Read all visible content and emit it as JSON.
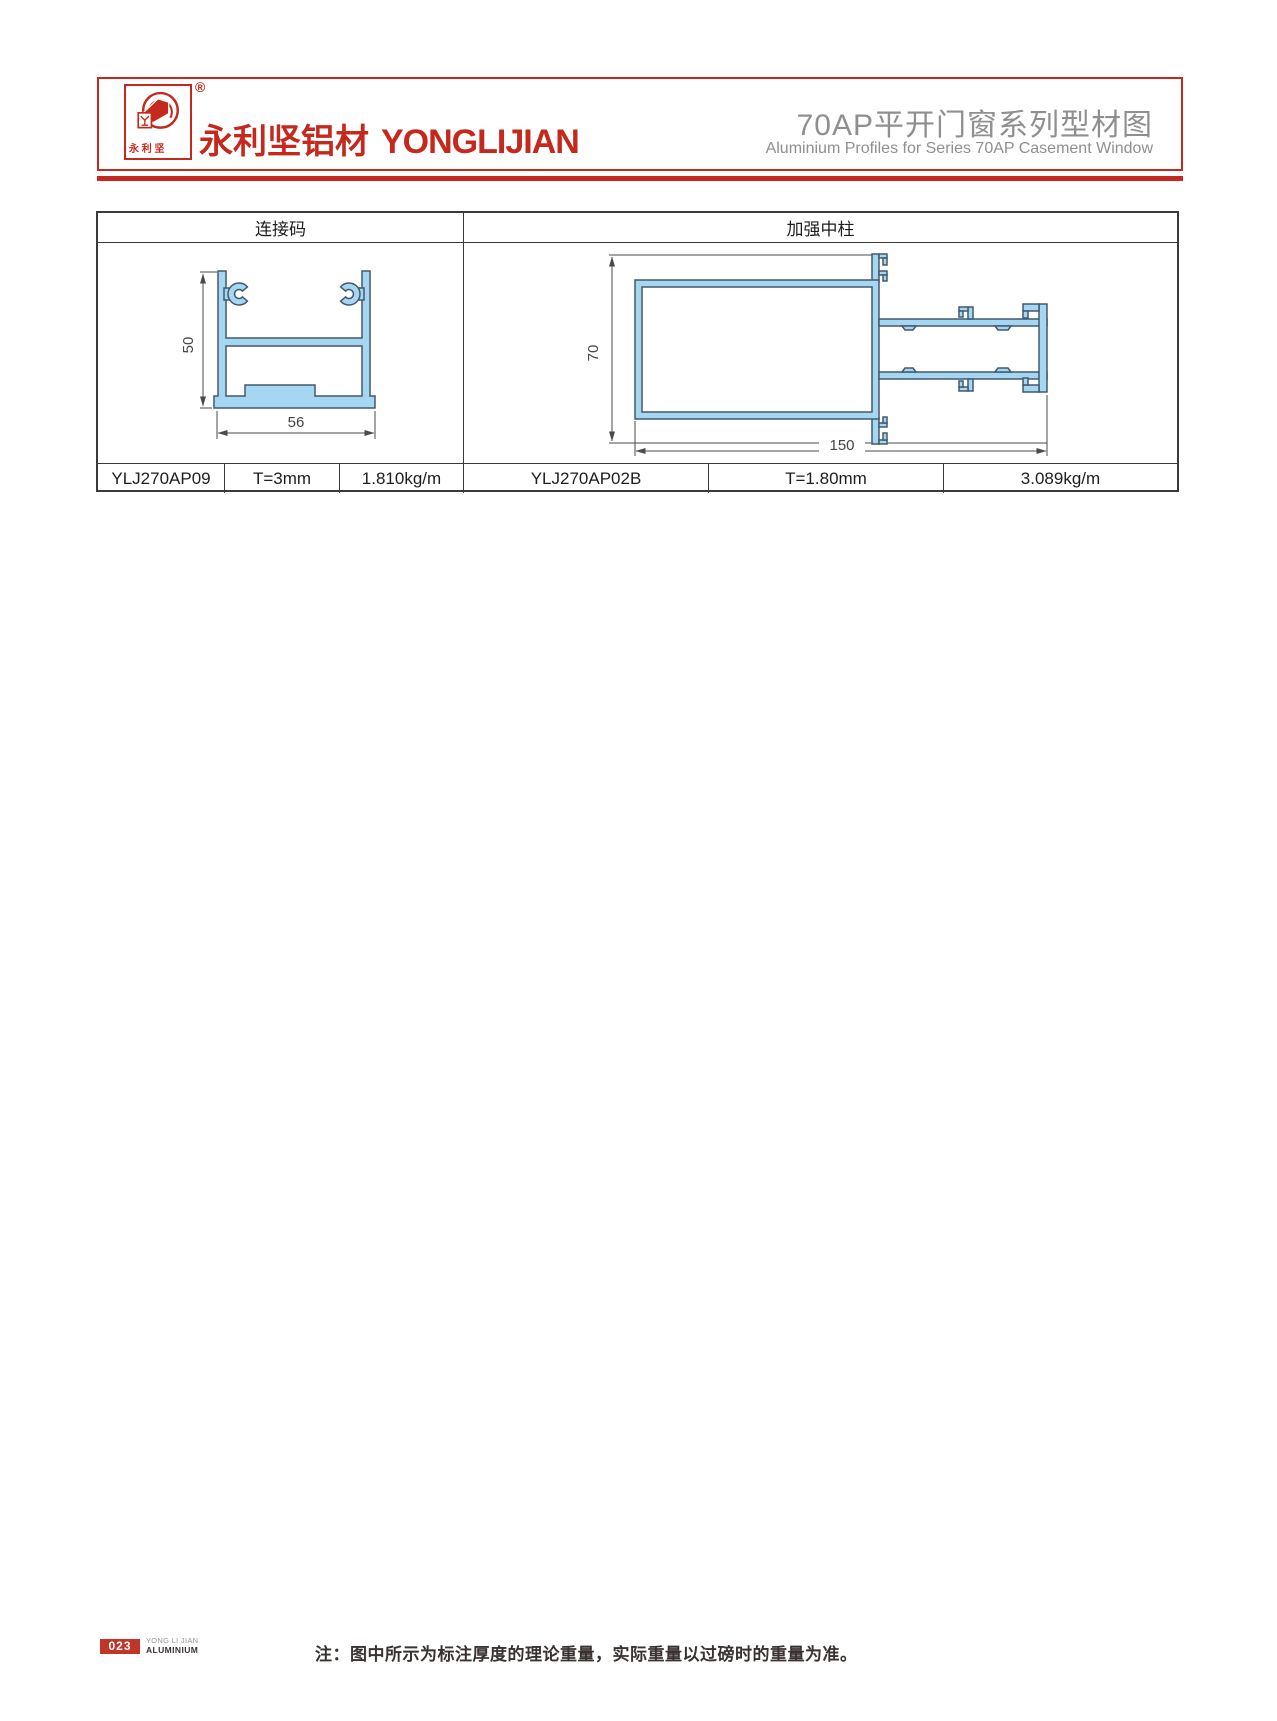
{
  "header": {
    "logo_chars": "永 利 坚",
    "registered_mark": "®",
    "brand_cn": "永利坚铝材",
    "brand_en": "YONGLIJIAN",
    "title_cn": "70AP平开门窗系列型材图",
    "title_en": "Aluminium Profiles for Series 70AP Casement Window"
  },
  "table": {
    "columns": [
      {
        "header": "连接码",
        "code": "YLJ270AP09",
        "thickness": "T=3mm",
        "weight": "1.810kg/m",
        "dim_height": "50",
        "dim_width": "56"
      },
      {
        "header": "加强中柱",
        "code": "YLJ270AP02B",
        "thickness": "T=1.80mm",
        "weight": "3.089kg/m",
        "dim_height": "70",
        "dim_width": "150"
      }
    ]
  },
  "footer": {
    "page_number": "023",
    "footer_brand_line1": "YONG LI JIAN",
    "footer_brand_line2": "ALUMINIUM",
    "note": "注：图中所示为标注厚度的理论重量，实际重量以过磅时的重量为准。"
  },
  "colors": {
    "accent_red": "#c5281c",
    "title_gray": "#8f8f8f",
    "profile_fill": "#a5d7f2",
    "profile_outline": "#44586c",
    "table_border": "#3a3a3a",
    "dim_line": "#4a4a4a"
  }
}
